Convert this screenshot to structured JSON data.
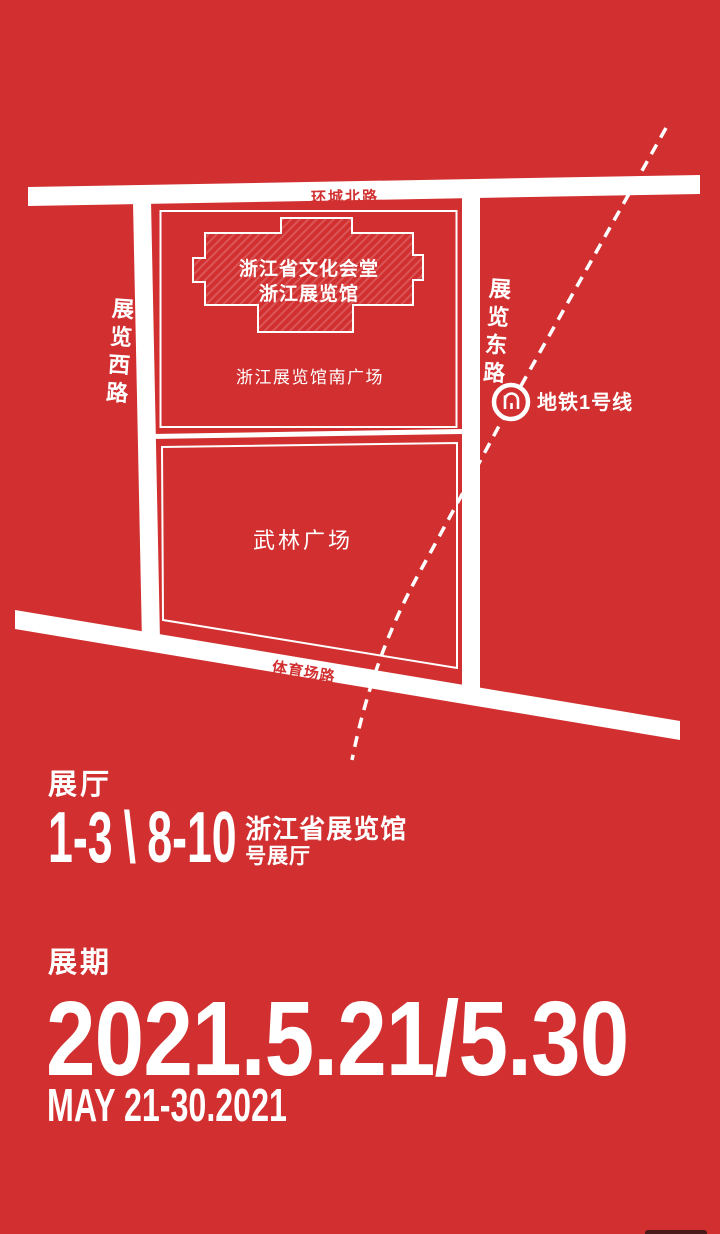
{
  "colors": {
    "background": "#d23030",
    "road": "#ffffff",
    "road_label": "#d23030",
    "text": "#ffffff"
  },
  "map": {
    "road_north": "环城北路",
    "road_west": "展览西路",
    "road_east": "展览东路",
    "road_south": "体育场路",
    "building_line1": "浙江省文化会堂",
    "building_line2": "浙江展览馆",
    "south_square": "浙江展览馆南广场",
    "wulin_square": "武林广场",
    "metro_line": "地铁1号线"
  },
  "halls": {
    "label": "展厅",
    "range1": "1-3",
    "separator": "\\",
    "range2": "8-10",
    "venue_line1": "浙江省展览馆",
    "venue_line2": "号展厅"
  },
  "schedule": {
    "label": "展期",
    "dates": "2021.5.21/5.30",
    "dates_en": "MAY 21-30.2021"
  }
}
